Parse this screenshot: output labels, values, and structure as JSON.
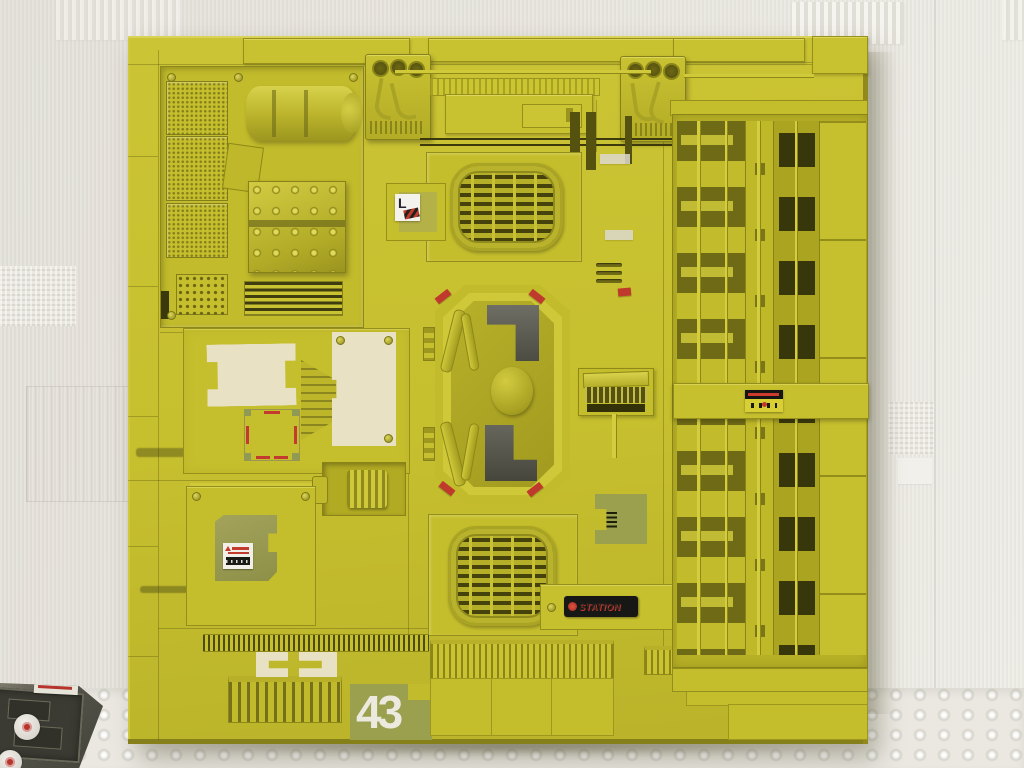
{
  "scene": {
    "subject": "Yellow scratch-built sci-fi spaceship wall panel model leaning against a wall",
    "floor": "bubble-wrap covered surface",
    "corner_object": "grey model hatch piece with round red-and-white decals"
  },
  "panel": {
    "number": "43",
    "decals": {
      "station": "STATION",
      "letter": "L"
    }
  },
  "colors": {
    "panel_yellow": "#c6bf2e",
    "panel_highlight": "#d8d252",
    "panel_shadow": "#8f8a1b",
    "recess_dark": "#6e6a16",
    "inset_grey": "#55544a",
    "olive_patch": "#9aa04e",
    "cream_masking": "#e9e1c4",
    "accent_red": "#bf3a2c",
    "decal_black": "#171715",
    "wall_white": "#e7e4de",
    "floor_white": "#eae8e1"
  }
}
